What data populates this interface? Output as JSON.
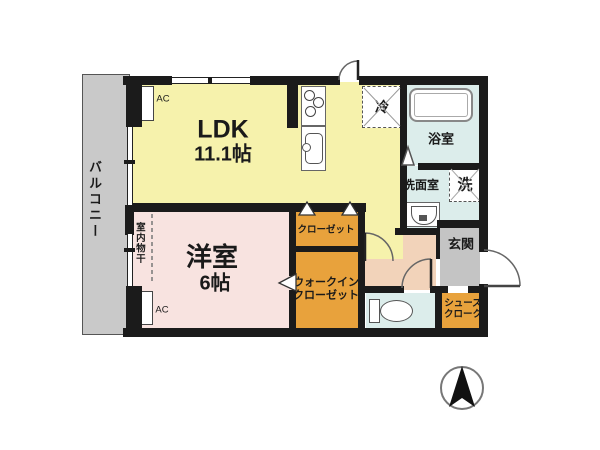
{
  "plan_title": "1LDK apartment floor plan",
  "rooms": {
    "balcony": {
      "label": "バルコニー"
    },
    "ldk": {
      "label": "LDK",
      "size": "11.1帖"
    },
    "bedroom": {
      "label": "洋室",
      "size": "6帖"
    },
    "bath": {
      "label": "浴室"
    },
    "washroom": {
      "label": "洗面室"
    },
    "washer": {
      "label": "洗"
    },
    "refrigerator": {
      "label": "冷"
    },
    "entrance": {
      "label": "玄関"
    },
    "closet": {
      "label": "クローゼット"
    },
    "walk_in_closet": {
      "line1": "ウォークイン",
      "line2": "クローゼット"
    },
    "shoes_cloak": {
      "line1": "シューズ",
      "line2": "クローク"
    },
    "indoor_drying": {
      "label": "室内物干"
    },
    "ac_top": {
      "label": "AC"
    },
    "ac_bottom": {
      "label": "AC"
    }
  },
  "icons": {
    "compass": "north-arrow",
    "kitchen": [
      "stove-burners",
      "sink"
    ],
    "sanitary": [
      "bathtub",
      "washbasin",
      "toilet"
    ]
  },
  "colors": {
    "wall": "#1b1b1b",
    "ldk_fill": "#f6f2ac",
    "bedroom_fill": "#f8e3e0",
    "storage_fill": "#e8a23c",
    "hall_fill": "#f2d3ba",
    "entrance_fill": "#c4c4c4",
    "wet_area_fill": "#dcedeb",
    "balcony_fill": "#c9c9c9"
  }
}
